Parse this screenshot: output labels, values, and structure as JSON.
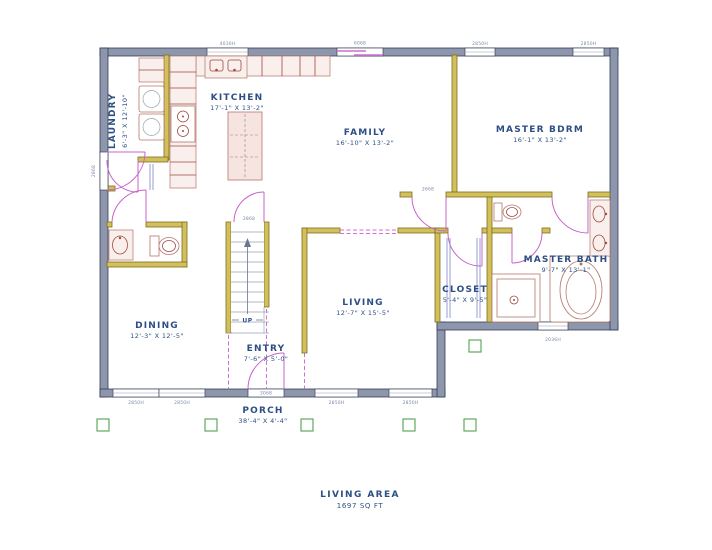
{
  "plan": {
    "rooms": {
      "laundry": {
        "name": "LAUNDRY",
        "dims": "6'-3\" X 12'-10\""
      },
      "kitchen": {
        "name": "KITCHEN",
        "dims": "17'-1\" X 13'-2\""
      },
      "family": {
        "name": "FAMILY",
        "dims": "16'-10\" X 13'-2\""
      },
      "master_bdrm": {
        "name": "MASTER BDRM",
        "dims": "16'-1\" X 13'-2\""
      },
      "dining": {
        "name": "DINING",
        "dims": "12'-3\" X 12'-5\""
      },
      "entry": {
        "name": "ENTRY",
        "dims": "7'-6\" X 5'-0\""
      },
      "living": {
        "name": "LIVING",
        "dims": "12'-7\" X 15'-5\""
      },
      "closet": {
        "name": "CLOSET",
        "dims": "5'-4\" X 9'-5\""
      },
      "master_bath": {
        "name": "MASTER BATH",
        "dims": "9'-7\" X 13'-1\""
      },
      "porch": {
        "name": "PORCH",
        "dims": "38'-4\" X 4'-4\""
      }
    },
    "stairs": {
      "label": "UP"
    },
    "area": {
      "label": "LIVING AREA",
      "value": "1697 SQ FT"
    },
    "callouts": {
      "kitchen_window": "4030H",
      "family_slider": "6068",
      "master_window_left": "2850H",
      "master_window_right": "2850H",
      "left_wall_door": "2868",
      "dining_window_left": "2850H",
      "dining_window_right": "2850H",
      "front_door": "3068",
      "living_window_left": "2850H",
      "living_window_right": "2850H",
      "bath_window": "2036H",
      "stair_door": "2868",
      "bedroom_door": "2668"
    },
    "colors": {
      "exterior_wall": "#8d96ab",
      "interior_wall": "#d3c05c",
      "door": "#c763c9",
      "fixture": "#b5766a",
      "label_text": "#2d4f85",
      "callout_text": "#7e89a4",
      "post": "#55a055",
      "closet_lines": "#8a92cc"
    }
  }
}
